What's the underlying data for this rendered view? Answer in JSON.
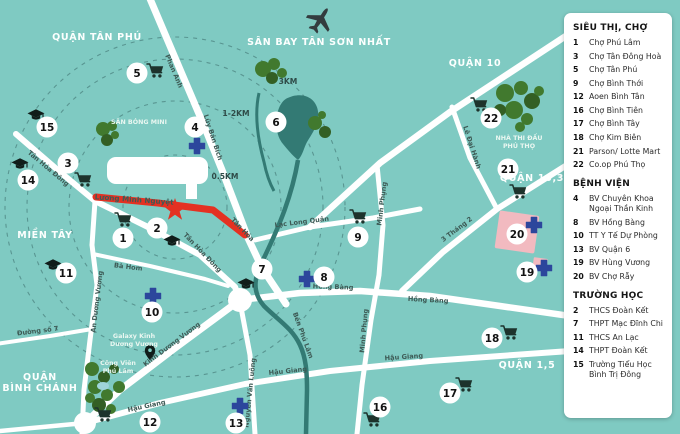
{
  "legend": {
    "sections": [
      {
        "title": "SIÊU THỊ, CHỢ",
        "items": [
          {
            "num": "1",
            "label": "Chợ Phú Lâm"
          },
          {
            "num": "3",
            "label": "Chợ Tân Đông Hoà"
          },
          {
            "num": "5",
            "label": "Chợ Tân Phú"
          },
          {
            "num": "9",
            "label": "Chợ Bình Thới"
          },
          {
            "num": "12",
            "label": "Aoen Bình Tân"
          },
          {
            "num": "16",
            "label": "Chợ Bình Tiên"
          },
          {
            "num": "17",
            "label": "Chợ Bình Tây"
          },
          {
            "num": "18",
            "label": "Chợ Kim Biên"
          },
          {
            "num": "21",
            "label": "Parson/ Lotte Mart"
          },
          {
            "num": "22",
            "label": "Co.op Phú Thọ"
          }
        ]
      },
      {
        "title": "BỆNH VIỆN",
        "items": [
          {
            "num": "4",
            "label": "BV Chuyên Khoa Ngoại Thần Kinh"
          },
          {
            "num": "8",
            "label": "BV Hồng Bàng"
          },
          {
            "num": "10",
            "label": "TT Y Tế Dự Phòng"
          },
          {
            "num": "13",
            "label": "BV Quận 6"
          },
          {
            "num": "19",
            "label": "BV Hùng Vương"
          },
          {
            "num": "20",
            "label": "BV Chợ Rẫy"
          }
        ]
      },
      {
        "title": "TRƯỜNG HỌC",
        "items": [
          {
            "num": "2",
            "label": "THCS Đoàn Kết"
          },
          {
            "num": "7",
            "label": "THPT Mạc Đĩnh Chi"
          },
          {
            "num": "11",
            "label": "THCS An Lạc"
          },
          {
            "num": "14",
            "label": "THPT Đoàn Kết"
          },
          {
            "num": "15",
            "label": "Trường Tiểu Học Bình Trị Đông"
          }
        ]
      }
    ]
  },
  "map": {
    "area_labels": [
      {
        "lines": [
          "QUẬN TÂN PHÚ"
        ],
        "x": 97,
        "y": 40
      },
      {
        "lines": [
          "SÂN BAY TÂN SƠN NHẤT"
        ],
        "x": 319,
        "y": 45
      },
      {
        "lines": [
          "QUẬN 10"
        ],
        "x": 475,
        "y": 66
      },
      {
        "lines": [
          "QUẬN 10,3"
        ],
        "x": 532,
        "y": 181
      },
      {
        "lines": [
          "QUẬN 1,5"
        ],
        "x": 527,
        "y": 368
      },
      {
        "lines": [
          "MIỀN TÂY"
        ],
        "x": 45,
        "y": 238
      },
      {
        "lines": [
          "QUẬN",
          "BÌNH CHÁNH"
        ],
        "x": 40,
        "y": 380
      }
    ],
    "road_labels": [
      {
        "t": "Phan Anh",
        "x": 172,
        "y": 72,
        "r": 67
      },
      {
        "t": "Lũy Bán Bích",
        "x": 211,
        "y": 138,
        "r": 72
      },
      {
        "t": "Tân Hóa Đông",
        "x": 47,
        "y": 170,
        "r": 40
      },
      {
        "t": "Tân Hòa Đông",
        "x": 201,
        "y": 254,
        "r": 46
      },
      {
        "t": "Tân Hóa",
        "x": 241,
        "y": 231,
        "r": 46
      },
      {
        "t": "An Dương Vương",
        "x": 99,
        "y": 302,
        "r": -83
      },
      {
        "t": "Bà Hom",
        "x": 128,
        "y": 269,
        "r": 7
      },
      {
        "t": "Đường số 7",
        "x": 38,
        "y": 333,
        "r": -7
      },
      {
        "t": "Kinh Dương Vương",
        "x": 173,
        "y": 346,
        "r": -37
      },
      {
        "t": "Nguyễn Văn Luông",
        "x": 252,
        "y": 393,
        "r": -84
      },
      {
        "t": "Hậu Giang",
        "x": 147,
        "y": 408,
        "r": -12
      },
      {
        "t": "Hậu Giang",
        "x": 288,
        "y": 373,
        "r": -6
      },
      {
        "t": "Hậu Giang",
        "x": 404,
        "y": 359,
        "r": -4
      },
      {
        "t": "Hồng Bàng",
        "x": 333,
        "y": 289,
        "r": 2
      },
      {
        "t": "Hồng Bàng",
        "x": 428,
        "y": 302,
        "r": 3
      },
      {
        "t": "Lạc Long Quân",
        "x": 302,
        "y": 224,
        "r": -7
      },
      {
        "t": "Minh Phụng",
        "x": 384,
        "y": 204,
        "r": -83
      },
      {
        "t": "Minh Phụng",
        "x": 366,
        "y": 331,
        "r": -85
      },
      {
        "t": "Lê Đại Hành",
        "x": 470,
        "y": 148,
        "r": 72
      },
      {
        "t": "3 Tháng 2",
        "x": 458,
        "y": 231,
        "r": -37
      },
      {
        "t": "Bến Phú Lâm",
        "x": 301,
        "y": 336,
        "r": 70
      }
    ],
    "place_labels": [
      {
        "lines": [
          "SÂN BÓNG MINI"
        ],
        "x": 139,
        "y": 124
      },
      {
        "lines": [
          "NHÀ THI ĐẤU",
          "PHÚ THỌ"
        ],
        "x": 519,
        "y": 140
      },
      {
        "lines": [
          "Công Viên",
          "Phú Lâm"
        ],
        "x": 118,
        "y": 365
      },
      {
        "lines": [
          "Galaxy Kinh",
          "Dương Vương"
        ],
        "x": 134,
        "y": 338
      }
    ],
    "distance_labels": [
      {
        "t": "3KM",
        "x": 288,
        "y": 84
      },
      {
        "t": "1-2KM",
        "x": 236,
        "y": 116
      },
      {
        "t": "0.5KM",
        "x": 225,
        "y": 179
      }
    ],
    "project_road_label": {
      "t": "Lương Minh Nguyệt",
      "x": 134,
      "y": 202,
      "r": 4
    },
    "markers": [
      {
        "n": "1",
        "x": 123,
        "y": 238,
        "icon": "cart",
        "ix": 123,
        "iy": 220
      },
      {
        "n": "2",
        "x": 157,
        "y": 228,
        "icon": "cap",
        "ix": 172,
        "iy": 241
      },
      {
        "n": "3",
        "x": 68,
        "y": 163,
        "icon": "cart",
        "ix": 83,
        "iy": 180
      },
      {
        "n": "4",
        "x": 195,
        "y": 127,
        "icon": "cross",
        "ix": 197,
        "iy": 146
      },
      {
        "n": "5",
        "x": 137,
        "y": 73,
        "icon": "cart",
        "ix": 155,
        "iy": 71
      },
      {
        "n": "6",
        "x": 276,
        "y": 122,
        "icon": null
      },
      {
        "n": "7",
        "x": 262,
        "y": 269,
        "icon": "cap",
        "ix": 246,
        "iy": 284
      },
      {
        "n": "8",
        "x": 324,
        "y": 277,
        "icon": "cross",
        "ix": 307,
        "iy": 279
      },
      {
        "n": "9",
        "x": 358,
        "y": 237,
        "icon": "cart",
        "ix": 358,
        "iy": 217
      },
      {
        "n": "10",
        "x": 152,
        "y": 312,
        "icon": "cross",
        "ix": 153,
        "iy": 296
      },
      {
        "n": "11",
        "x": 66,
        "y": 273,
        "icon": "cap",
        "ix": 53,
        "iy": 265
      },
      {
        "n": "12",
        "x": 150,
        "y": 422,
        "icon": "cart",
        "ix": 103,
        "iy": 415
      },
      {
        "n": "13",
        "x": 236,
        "y": 423,
        "icon": "cross",
        "ix": 240,
        "iy": 406
      },
      {
        "n": "14",
        "x": 28,
        "y": 180,
        "icon": "cap",
        "ix": 20,
        "iy": 164
      },
      {
        "n": "15",
        "x": 47,
        "y": 127,
        "icon": "cap",
        "ix": 36,
        "iy": 115
      },
      {
        "n": "16",
        "x": 380,
        "y": 407,
        "icon": "cart",
        "ix": 372,
        "iy": 420
      },
      {
        "n": "17",
        "x": 450,
        "y": 393,
        "icon": "cart",
        "ix": 464,
        "iy": 385
      },
      {
        "n": "18",
        "x": 492,
        "y": 338,
        "icon": "cart",
        "ix": 509,
        "iy": 333
      },
      {
        "n": "19",
        "x": 527,
        "y": 272,
        "icon": "cross",
        "ix": 544,
        "iy": 268
      },
      {
        "n": "20",
        "x": 517,
        "y": 234,
        "icon": "cross",
        "ix": 534,
        "iy": 225
      },
      {
        "n": "21",
        "x": 508,
        "y": 169,
        "icon": "cart",
        "ix": 518,
        "iy": 192
      },
      {
        "n": "22",
        "x": 491,
        "y": 118,
        "icon": "cart",
        "ix": 479,
        "iy": 105
      }
    ]
  },
  "colors": {
    "map_bg": "#7fcac2",
    "water": "#337a74",
    "road": "#ffffff",
    "project_red": "#e43122",
    "hospital_blue": "#2c469c",
    "tree_green": "#41792e",
    "hospital_block_pink": "#f2bac0",
    "label_dark": "#3d5a55",
    "label_light": "#ffffff"
  }
}
